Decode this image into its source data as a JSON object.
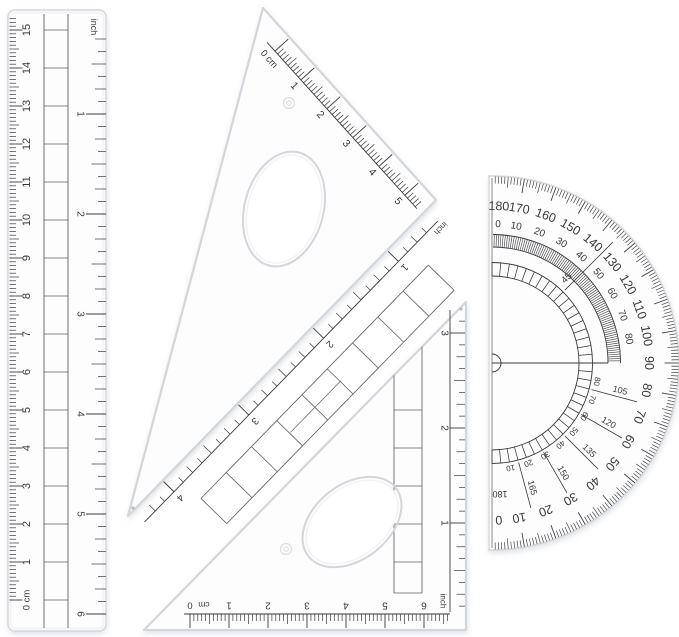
{
  "colors": {
    "background": "#ffffff",
    "ink": "#39393c",
    "plastic_stroke": "#d3d6da",
    "plastic_fill": "#fdfdfe",
    "inner_highlight": "#f2f3f6",
    "strip_line": "#616165",
    "shadow": "#8e96a3"
  },
  "ruler": {
    "side_cm_labels": [
      "0 cm",
      "1",
      "2",
      "3",
      "4",
      "5",
      "6",
      "7",
      "8",
      "9",
      "10",
      "11",
      "12",
      "13",
      "14",
      "15"
    ],
    "side_inch_unit": "inch",
    "side_inch_labels": [
      "1",
      "2",
      "3",
      "4",
      "5",
      "6"
    ]
  },
  "set_square_30_60": {
    "cm_zero_label": "0 cm",
    "cm_labels": [
      "1",
      "2",
      "3",
      "4",
      "5"
    ],
    "inch_unit_label": "inch",
    "inch_labels": [
      "1",
      "2",
      "3",
      "4"
    ]
  },
  "set_square_45": {
    "cm_zero_label": "0 cm",
    "cm_labels": [
      "1",
      "2",
      "3",
      "4",
      "5",
      "6"
    ],
    "inch_unit_label": "inch",
    "inch_labels": [
      "1",
      "2",
      "3"
    ]
  },
  "protractor": {
    "outer_scale_labels": [
      "180",
      "170",
      "160",
      "150",
      "140",
      "130",
      "120",
      "110",
      "100",
      "90",
      "80",
      "70",
      "60",
      "50",
      "40",
      "30",
      "20",
      "10",
      "0"
    ],
    "inner_scale_labels": [
      "0",
      "10",
      "20",
      "30",
      "40",
      "50",
      "60",
      "70",
      "80"
    ],
    "diagonal_label": "45",
    "fifteen_step_labels": [
      "105",
      "120",
      "135",
      "150",
      "165",
      "180"
    ],
    "ladder_scale_labels": [
      "10",
      "20",
      "30",
      "40",
      "50",
      "60",
      "70",
      "80"
    ]
  }
}
